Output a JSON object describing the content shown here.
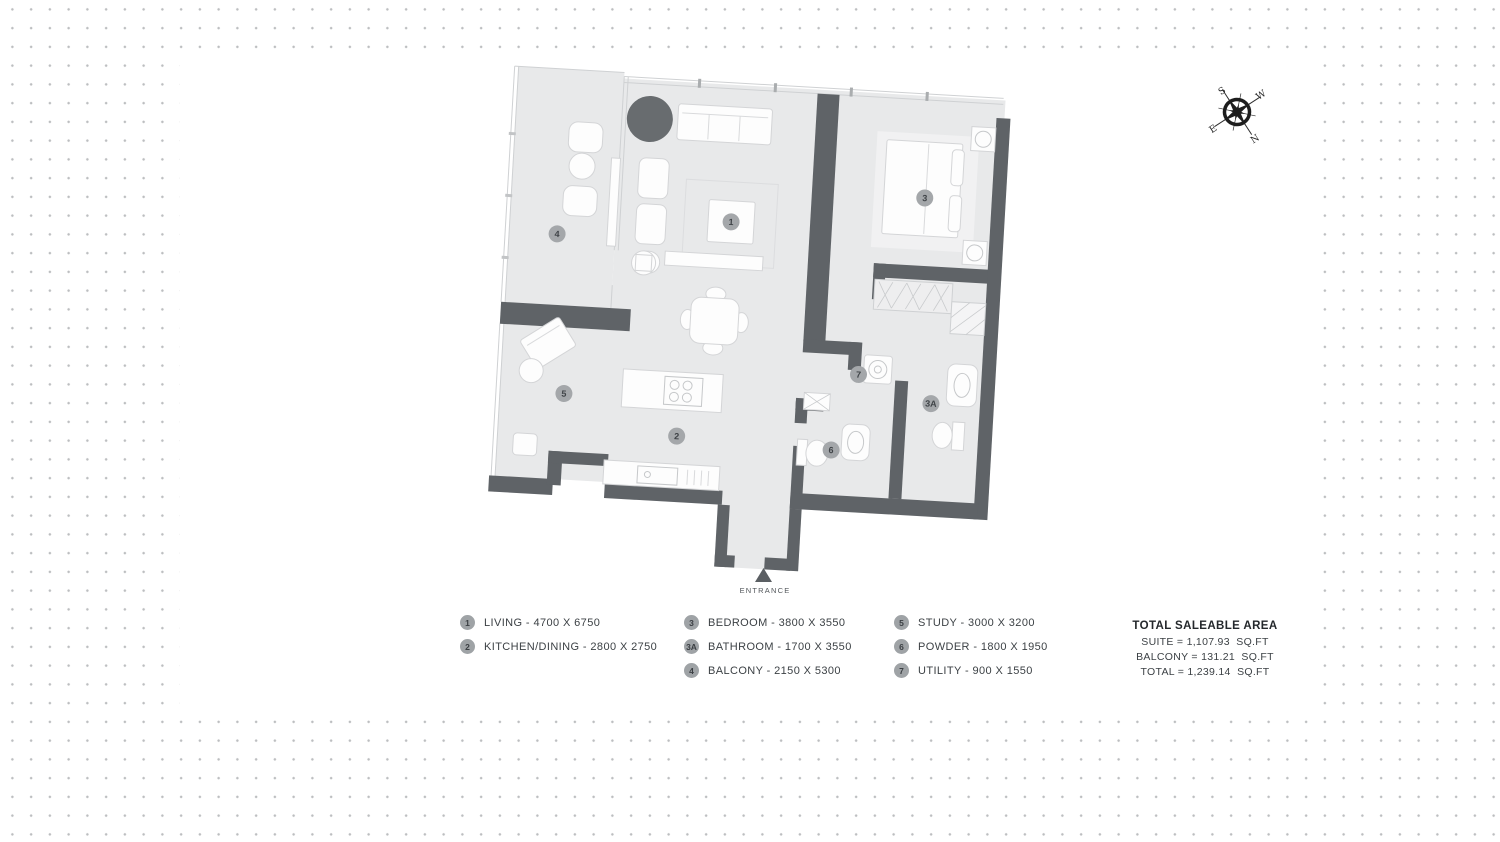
{
  "plan": {
    "entrance_label": "ENTRANCE",
    "badges": {
      "living": "1",
      "kitchen_dining": "2",
      "bedroom": "3",
      "bathroom": "3A",
      "balcony": "4",
      "study": "5",
      "powder": "6",
      "utility": "7"
    }
  },
  "compass": {
    "n": "N",
    "s": "S",
    "e": "E",
    "w": "W"
  },
  "legend": {
    "columns": [
      {
        "items": [
          {
            "badge": "1",
            "label": "LIVING - 4700 X 6750"
          },
          {
            "badge": "2",
            "label": "KITCHEN/DINING - 2800 X 2750"
          }
        ]
      },
      {
        "items": [
          {
            "badge": "3",
            "label": "BEDROOM - 3800 X 3550"
          },
          {
            "badge": "3A",
            "label": "BATHROOM - 1700 X 3550"
          },
          {
            "badge": "4",
            "label": "BALCONY - 2150 X 5300"
          }
        ]
      },
      {
        "items": [
          {
            "badge": "5",
            "label": "STUDY - 3000 X 3200"
          },
          {
            "badge": "6",
            "label": "POWDER - 1800 X 1950"
          },
          {
            "badge": "7",
            "label": "UTILITY - 900 X 1550"
          }
        ]
      }
    ]
  },
  "totals": {
    "heading": "TOTAL SALEABLE AREA",
    "lines": [
      "SUITE = 1,107.93  SQ.FT",
      "BALCONY = 131.21  SQ.FT",
      "TOTAL = 1,239.14  SQ.FT"
    ]
  },
  "colors": {
    "wall": "#5f6367",
    "floor": "#e8e9ea",
    "badge": "#a4a7aa",
    "plant": "#686c6f",
    "text": "#3c4145"
  }
}
